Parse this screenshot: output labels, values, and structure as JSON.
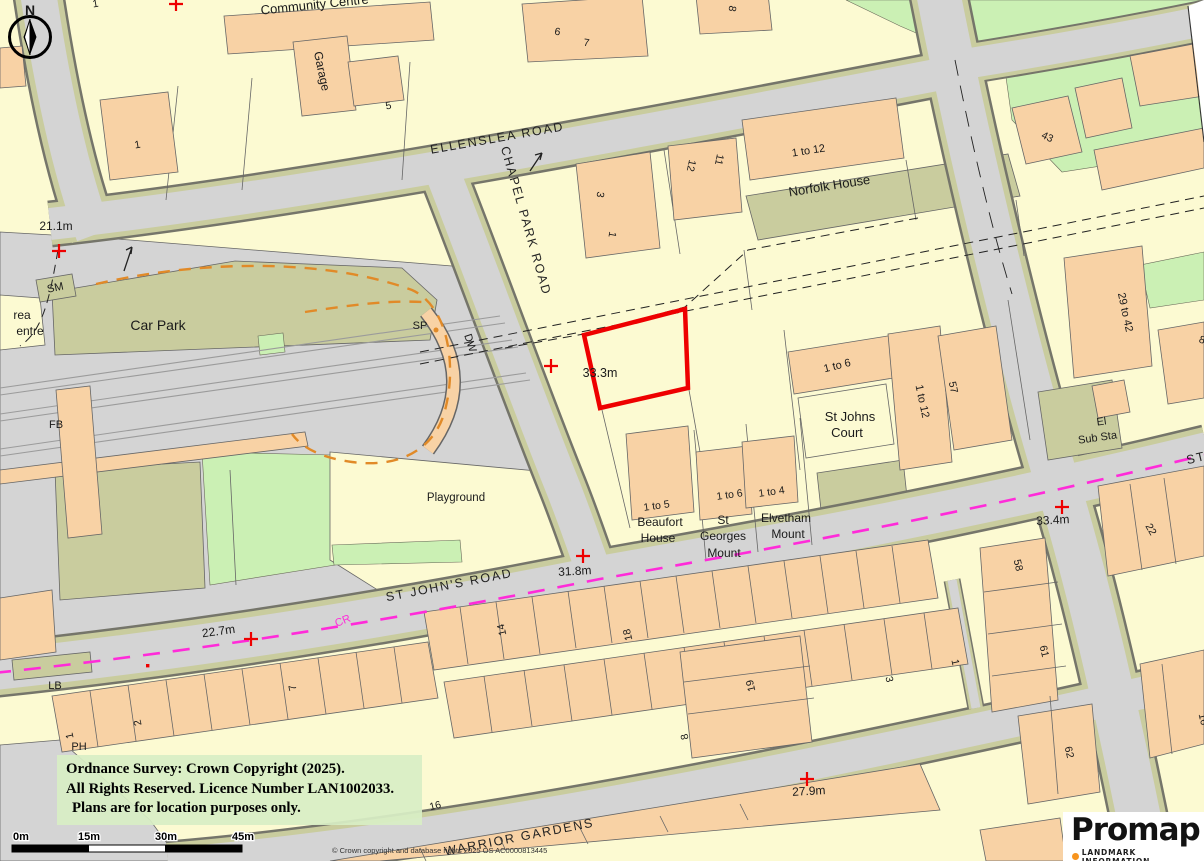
{
  "map": {
    "roads": {
      "ellenslea": "ELLENSLEA ROAD",
      "chapel_park": "CHAPEL PARK ROAD",
      "st_johns": "ST JOHN'S ROAD",
      "st_johns_cut": "ST",
      "warrior": "WARRIOR GARDENS"
    },
    "places": {
      "community_centre": "Community Centre",
      "garage": "Garage",
      "car_park": "Car Park",
      "playground": "Playground",
      "norfolk_house": "Norfolk House",
      "st_johns_court": [
        "St Johns",
        "Court"
      ],
      "beaufort_house": [
        "Beaufort",
        "House"
      ],
      "st_georges_mount": [
        "St",
        "Georges",
        "Mount"
      ],
      "elvetham_mount": [
        "Elvetham",
        "Mount"
      ],
      "el_sub_sta": [
        "El",
        "Sub Sta"
      ],
      "area_cut": "rea",
      "centre_cut": "entre"
    },
    "heights": {
      "h21_1": "21.1m",
      "h22_7": "22.7m",
      "h31_8": "31.8m",
      "h33_3": "33.3m",
      "h33_4": "33.4m",
      "h27_9": "27.9m"
    },
    "numbers": {
      "n1_nw": "1",
      "n1_top": "1",
      "n5": "5",
      "n6": "6",
      "n7_top": "7",
      "n8_top": "8",
      "n3_cp": "3",
      "n1_cp": "1",
      "n12": "12",
      "n11": "11",
      "n43": "43",
      "n57": "57",
      "n8_e": "8",
      "n14": "14",
      "n18": "18",
      "n19": "19",
      "n16": "16",
      "n7_t": "7",
      "n2": "2",
      "n1_t": "1",
      "n8_t": "8",
      "n3_se": "3",
      "n1_se": "1",
      "n58": "58",
      "n61": "61",
      "n62": "62",
      "n22": "22",
      "n16_e": "16"
    },
    "ranges": {
      "r1to12_a": "1 to 12",
      "r1to12_b": "1 to 12",
      "r1to6_a": "1 to 6",
      "r1to6_b": "1 to 6",
      "r1to5": "1 to 5",
      "r1to4": "1 to 4",
      "r29to42": "29 to 42"
    },
    "abbr": {
      "sm": "SM",
      "sp": "SP",
      "dw": "DW",
      "fb": "FB",
      "lb": "LB",
      "ph": "PH",
      "cr": "CR"
    },
    "compass": {
      "north": "N"
    }
  },
  "scalebar": {
    "t0": "0m",
    "t15": "15m",
    "t30": "30m",
    "t45": "45m"
  },
  "copyright_box": {
    "line1": "Ordnance Survey: Crown Copyright (2025).",
    "line2": "All Rights Reserved. Licence Number LAN1002033.",
    "line3": "Plans are for location purposes only."
  },
  "fine_print": "© Crown copyright and database rights 2025 OS AC0000813445",
  "promap": {
    "name": "Promap",
    "tagline": "LANDMARK INFORMATION"
  },
  "colors": {
    "plot_outline": "#EE0000",
    "route_magenta": "#FF2BD9",
    "track_orange": "#E18A28",
    "building": "#F8D2A5",
    "parcel": "#FCFAD2",
    "road": "#D4D4D4",
    "verge": "#C9CC9E",
    "green": "#CBF0B4",
    "promap_dot": "#F7941E",
    "copyright_bg": "#DDEFC9"
  }
}
